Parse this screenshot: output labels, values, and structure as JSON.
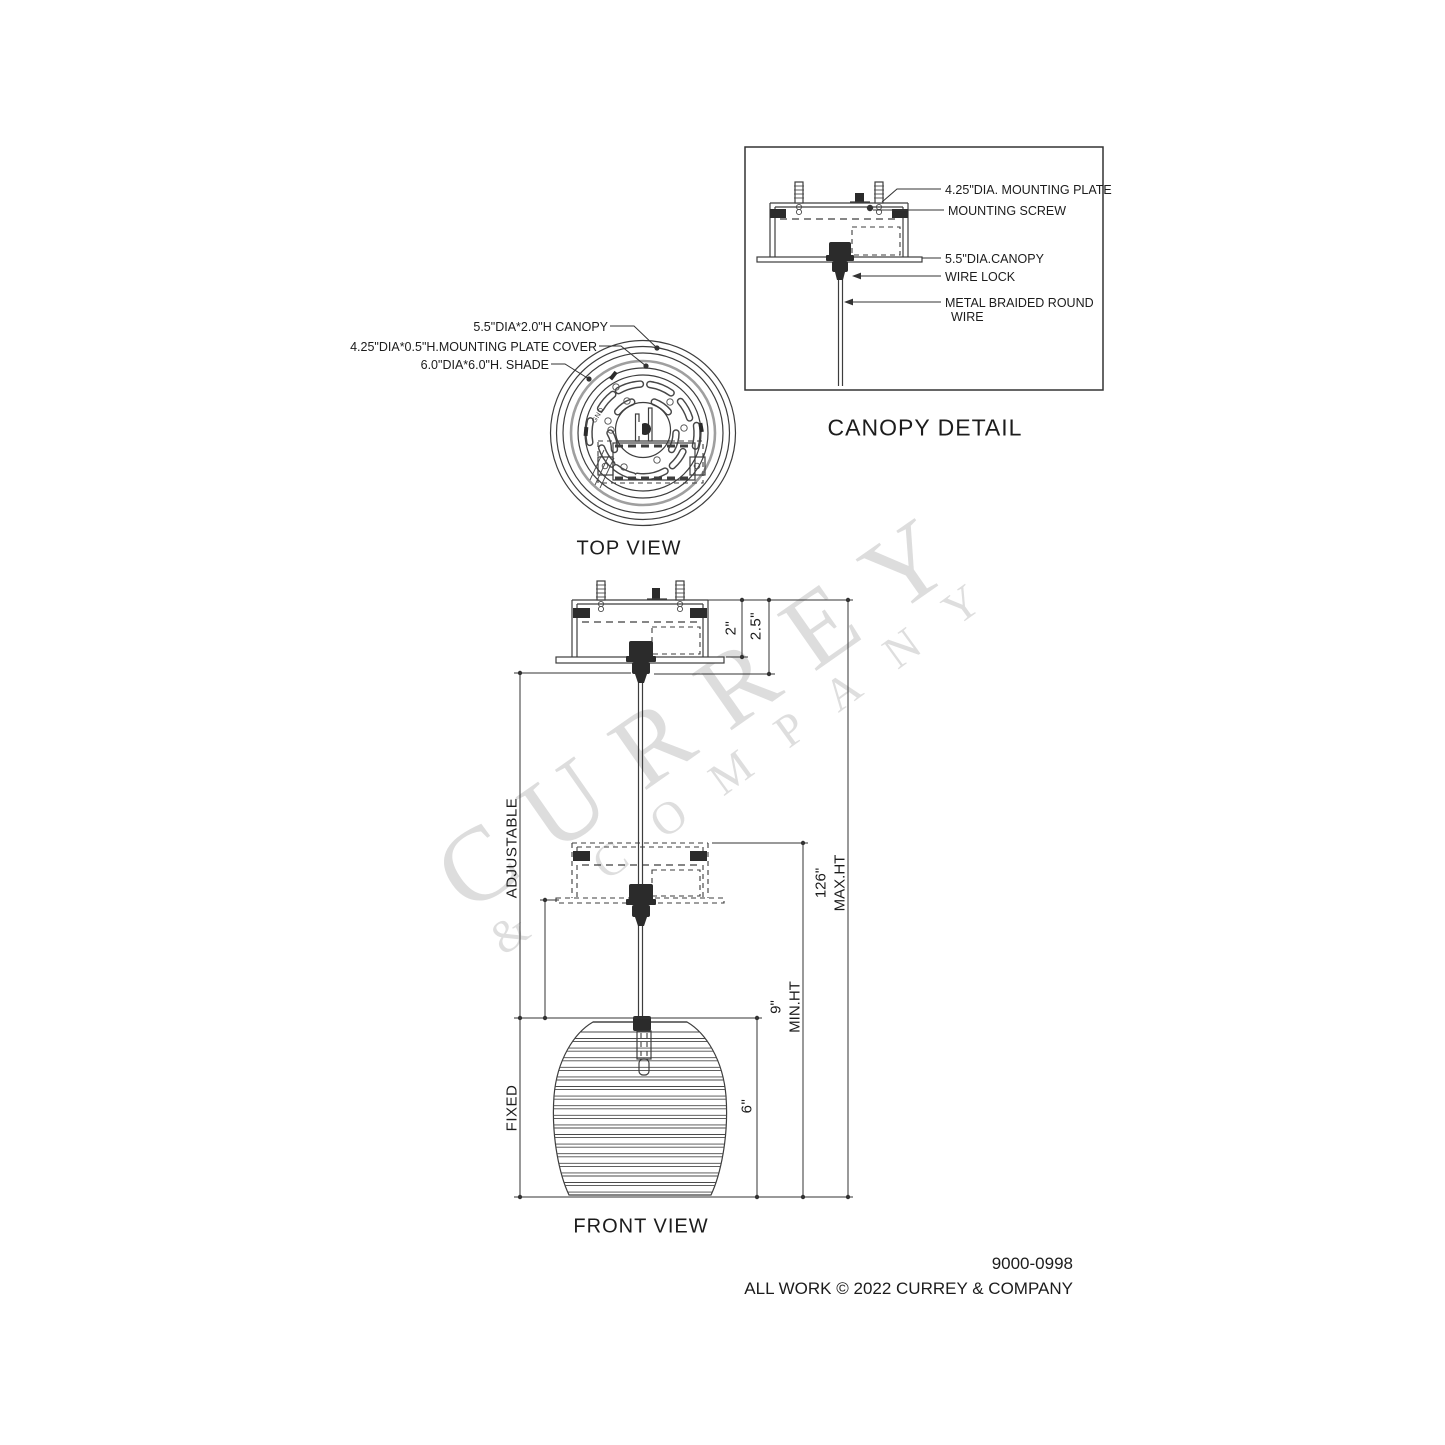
{
  "watermark": {
    "line1": "CURREY",
    "line2": "& COMPANY"
  },
  "canopy_detail": {
    "title": "CANOPY DETAIL",
    "labels": {
      "mounting_plate": "4.25\"DIA. MOUNTING PLATE",
      "mounting_screw": "MOUNTING SCREW",
      "canopy": "5.5\"DIA.CANOPY",
      "wire_lock": "WIRE LOCK",
      "wire_line1": "METAL BRAIDED ROUND",
      "wire_line2": "WIRE"
    }
  },
  "top_view": {
    "title": "TOP VIEW",
    "labels": {
      "canopy": "5.5\"DIA*2.0\"H CANOPY",
      "plate_cover": "4.25\"DIA*0.5\"H.MOUNTING PLATE COVER",
      "shade": "6.0\"DIA*6.0\"H. SHADE"
    },
    "gnd": "GND"
  },
  "front_view": {
    "title": "FRONT VIEW",
    "dimensions": {
      "canopy_height": "2\"",
      "canopy_total": "2.5\"",
      "adjustable": "ADJUSTABLE",
      "fixed": "FIXED",
      "shade_height": "6\"",
      "min_height_line1": "9\"",
      "min_height_line2": "MIN.HT",
      "max_height_line1": "126\"",
      "max_height_line2": "MAX.HT"
    }
  },
  "footer": {
    "model": "9000-0998",
    "copyright": "ALL WORK © 2022 CURREY & COMPANY"
  }
}
